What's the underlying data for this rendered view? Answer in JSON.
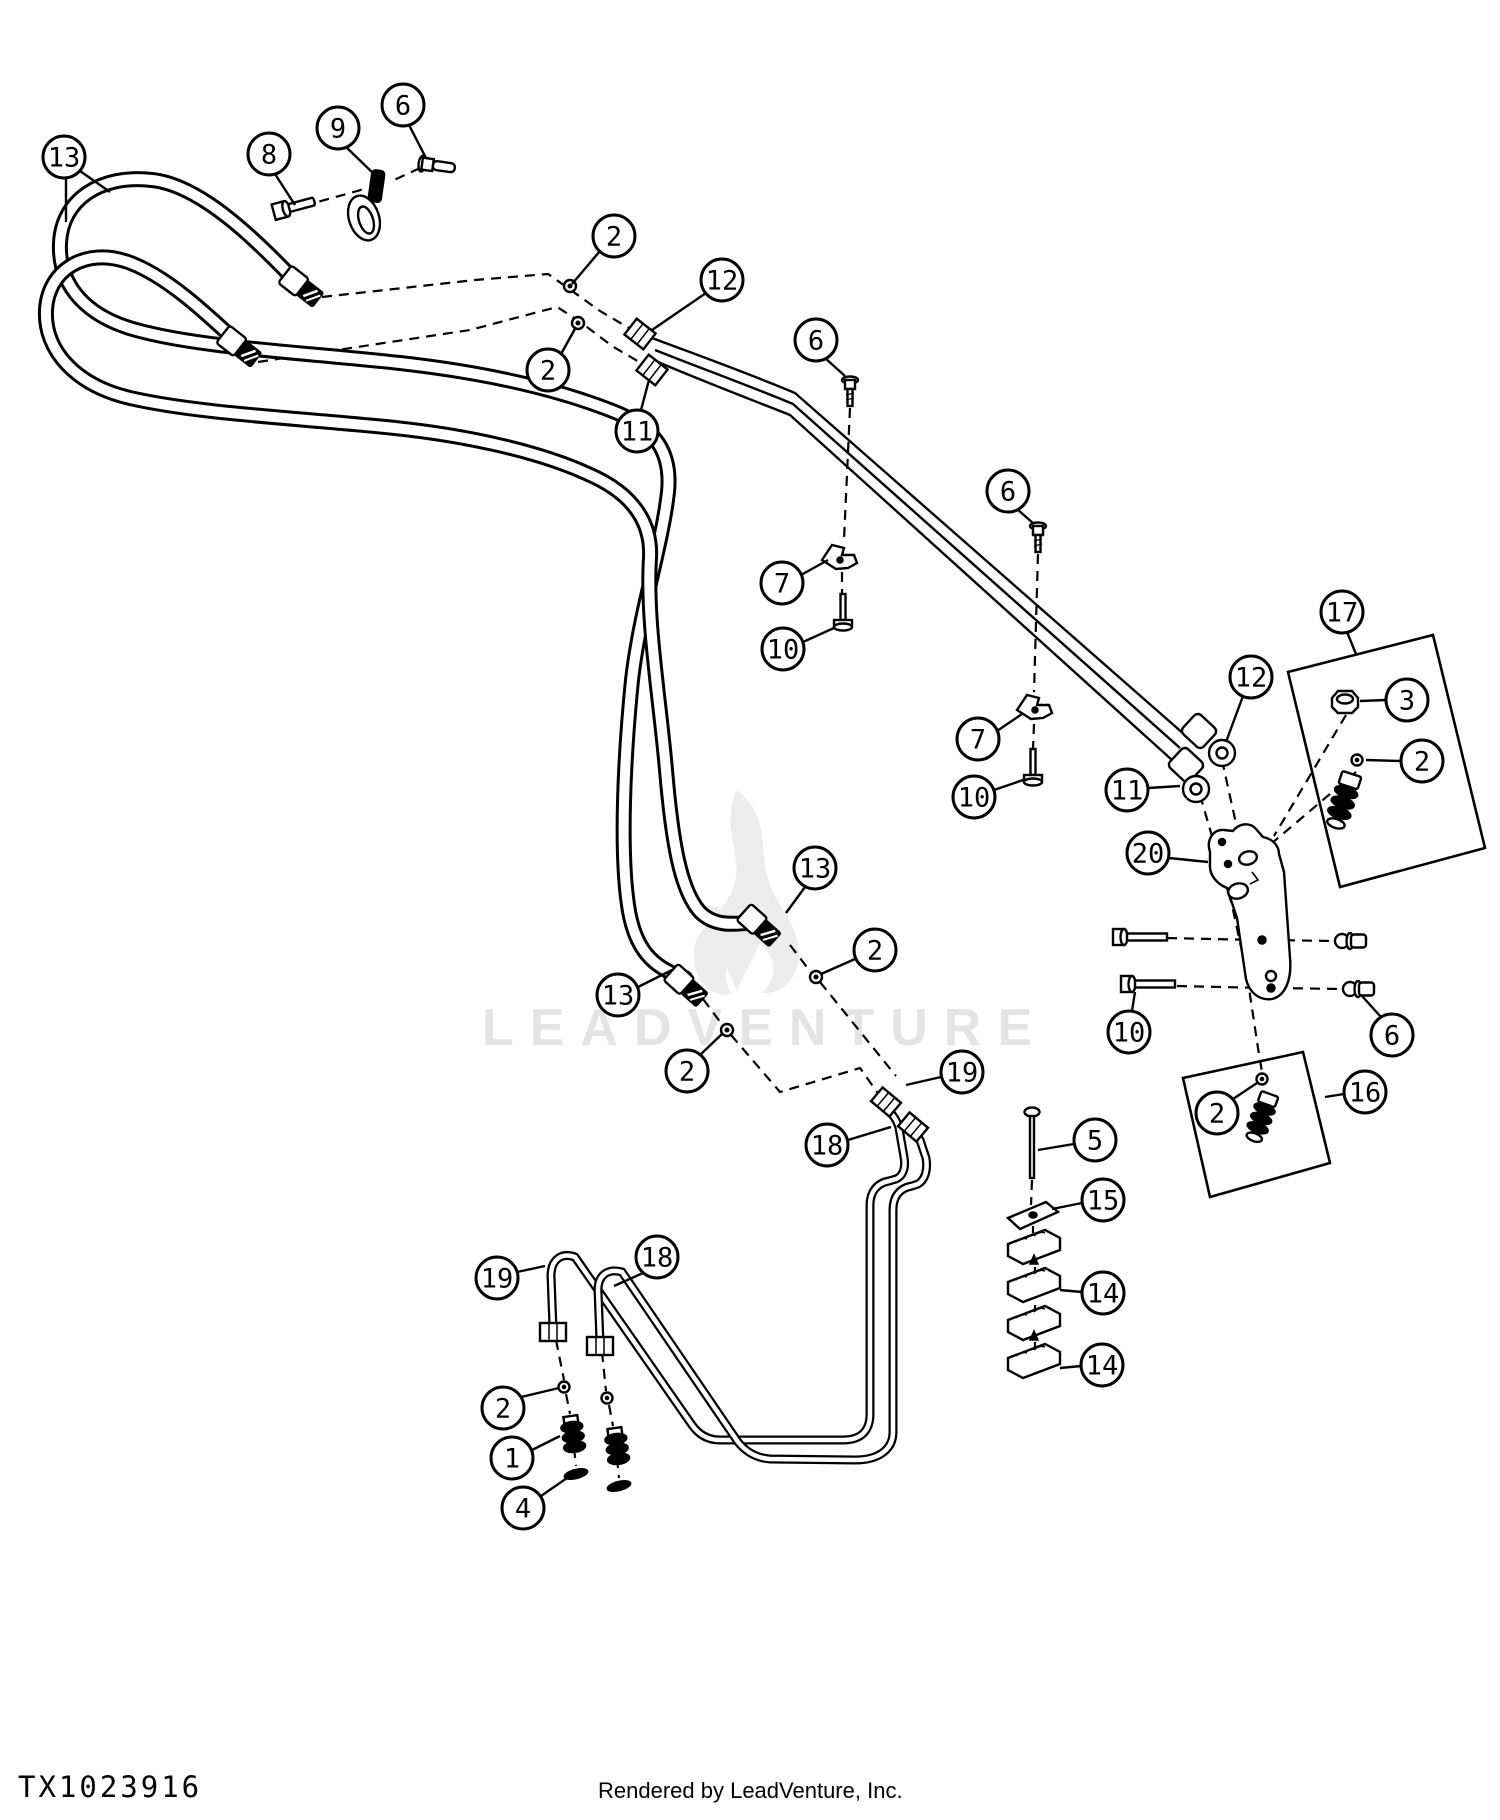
{
  "document": {
    "type": "exploded-parts-diagram",
    "drawing_number": "TX1023916",
    "footer_credit": "Rendered by LeadVenture, Inc."
  },
  "watermark": {
    "text": "LEADVENTURE"
  },
  "colors": {
    "line": "#000000",
    "background": "#ffffff",
    "watermark": "#ececec",
    "callout_fill": "#ffffff"
  },
  "callouts": [
    {
      "label": "13",
      "cx": 64,
      "cy": 157,
      "leaders": [
        [
          80,
          171,
          110,
          192
        ],
        [
          66,
          178,
          66,
          222
        ]
      ]
    },
    {
      "label": "8",
      "cx": 269,
      "cy": 154,
      "leaders": [
        [
          275,
          174,
          295,
          205
        ]
      ]
    },
    {
      "label": "9",
      "cx": 338,
      "cy": 128,
      "leaders": [
        [
          346,
          147,
          375,
          175
        ]
      ]
    },
    {
      "label": "6",
      "cx": 403,
      "cy": 105,
      "leaders": [
        [
          409,
          125,
          426,
          158
        ]
      ]
    },
    {
      "label": "2",
      "cx": 614,
      "cy": 236,
      "leaders": [
        [
          600,
          251,
          572,
          284
        ]
      ]
    },
    {
      "label": "12",
      "cx": 722,
      "cy": 280,
      "leaders": [
        [
          706,
          293,
          652,
          330
        ]
      ]
    },
    {
      "label": "2",
      "cx": 548,
      "cy": 370,
      "leaders": [
        [
          561,
          354,
          576,
          327
        ]
      ]
    },
    {
      "label": "11",
      "cx": 637,
      "cy": 431,
      "leaders": [
        [
          641,
          410,
          649,
          380
        ]
      ]
    },
    {
      "label": "6",
      "cx": 816,
      "cy": 340,
      "leaders": [
        [
          825,
          358,
          845,
          376
        ]
      ]
    },
    {
      "label": "6",
      "cx": 1008,
      "cy": 491,
      "leaders": [
        [
          1017,
          509,
          1034,
          524
        ]
      ]
    },
    {
      "label": "7",
      "cx": 782,
      "cy": 583,
      "leaders": [
        [
          801,
          575,
          828,
          560
        ]
      ]
    },
    {
      "label": "10",
      "cx": 783,
      "cy": 649,
      "leaders": [
        [
          803,
          642,
          834,
          628
        ]
      ]
    },
    {
      "label": "7",
      "cx": 978,
      "cy": 739,
      "leaders": [
        [
          997,
          731,
          1022,
          714
        ]
      ]
    },
    {
      "label": "10",
      "cx": 974,
      "cy": 797,
      "leaders": [
        [
          994,
          790,
          1026,
          779
        ]
      ]
    },
    {
      "label": "12",
      "cx": 1251,
      "cy": 677,
      "leaders": [
        [
          1243,
          696,
          1226,
          742
        ]
      ]
    },
    {
      "label": "11",
      "cx": 1127,
      "cy": 790,
      "leaders": [
        [
          1148,
          788,
          1180,
          786
        ]
      ]
    },
    {
      "label": "17",
      "cx": 1342,
      "cy": 612,
      "leaders": [
        [
          1347,
          632,
          1356,
          654
        ]
      ]
    },
    {
      "label": "3",
      "cx": 1407,
      "cy": 700,
      "leaders": [
        [
          1386,
          700,
          1360,
          701
        ]
      ]
    },
    {
      "label": "2",
      "cx": 1422,
      "cy": 761,
      "leaders": [
        [
          1401,
          761,
          1366,
          760
        ]
      ]
    },
    {
      "label": "20",
      "cx": 1148,
      "cy": 853,
      "leaders": [
        [
          1169,
          858,
          1208,
          862
        ]
      ]
    },
    {
      "label": "10",
      "cx": 1129,
      "cy": 1032,
      "leaders": [
        [
          1132,
          1011,
          1135,
          992
        ]
      ]
    },
    {
      "label": "6",
      "cx": 1392,
      "cy": 1035,
      "leaders": [
        [
          1381,
          1017,
          1362,
          996
        ]
      ]
    },
    {
      "label": "2",
      "cx": 1217,
      "cy": 1113,
      "leaders": [
        [
          1233,
          1099,
          1257,
          1083
        ]
      ]
    },
    {
      "label": "16",
      "cx": 1365,
      "cy": 1092,
      "leaders": [
        [
          1344,
          1094,
          1325,
          1097
        ]
      ]
    },
    {
      "label": "13",
      "cx": 815,
      "cy": 868,
      "leaders": [
        [
          805,
          887,
          786,
          913
        ]
      ]
    },
    {
      "label": "2",
      "cx": 875,
      "cy": 950,
      "leaders": [
        [
          855,
          959,
          821,
          974
        ]
      ]
    },
    {
      "label": "13",
      "cx": 618,
      "cy": 995,
      "leaders": [
        [
          638,
          987,
          672,
          970
        ]
      ]
    },
    {
      "label": "2",
      "cx": 687,
      "cy": 1071,
      "leaders": [
        [
          700,
          1055,
          723,
          1033
        ]
      ]
    },
    {
      "label": "19",
      "cx": 962,
      "cy": 1072,
      "leaders": [
        [
          941,
          1077,
          906,
          1085
        ]
      ]
    },
    {
      "label": "18",
      "cx": 827,
      "cy": 1145,
      "leaders": [
        [
          848,
          1140,
          891,
          1127
        ]
      ]
    },
    {
      "label": "19",
      "cx": 497,
      "cy": 1278,
      "leaders": [
        [
          517,
          1272,
          545,
          1266
        ]
      ]
    },
    {
      "label": "18",
      "cx": 657,
      "cy": 1257,
      "leaders": [
        [
          643,
          1273,
          614,
          1286
        ]
      ]
    },
    {
      "label": "2",
      "cx": 503,
      "cy": 1408,
      "leaders": [
        [
          521,
          1397,
          559,
          1388
        ]
      ]
    },
    {
      "label": "1",
      "cx": 512,
      "cy": 1458,
      "leaders": [
        [
          532,
          1450,
          560,
          1436
        ]
      ]
    },
    {
      "label": "4",
      "cx": 523,
      "cy": 1508,
      "leaders": [
        [
          541,
          1496,
          567,
          1478
        ]
      ]
    },
    {
      "label": "5",
      "cx": 1095,
      "cy": 1140,
      "leaders": [
        [
          1074,
          1144,
          1038,
          1150
        ]
      ]
    },
    {
      "label": "15",
      "cx": 1103,
      "cy": 1200,
      "leaders": [
        [
          1082,
          1203,
          1052,
          1209
        ]
      ]
    },
    {
      "label": "14",
      "cx": 1103,
      "cy": 1293,
      "leaders": [
        [
          1082,
          1292,
          1060,
          1290
        ]
      ]
    },
    {
      "label": "14",
      "cx": 1102,
      "cy": 1365,
      "leaders": [
        [
          1081,
          1366,
          1060,
          1368
        ]
      ]
    }
  ]
}
